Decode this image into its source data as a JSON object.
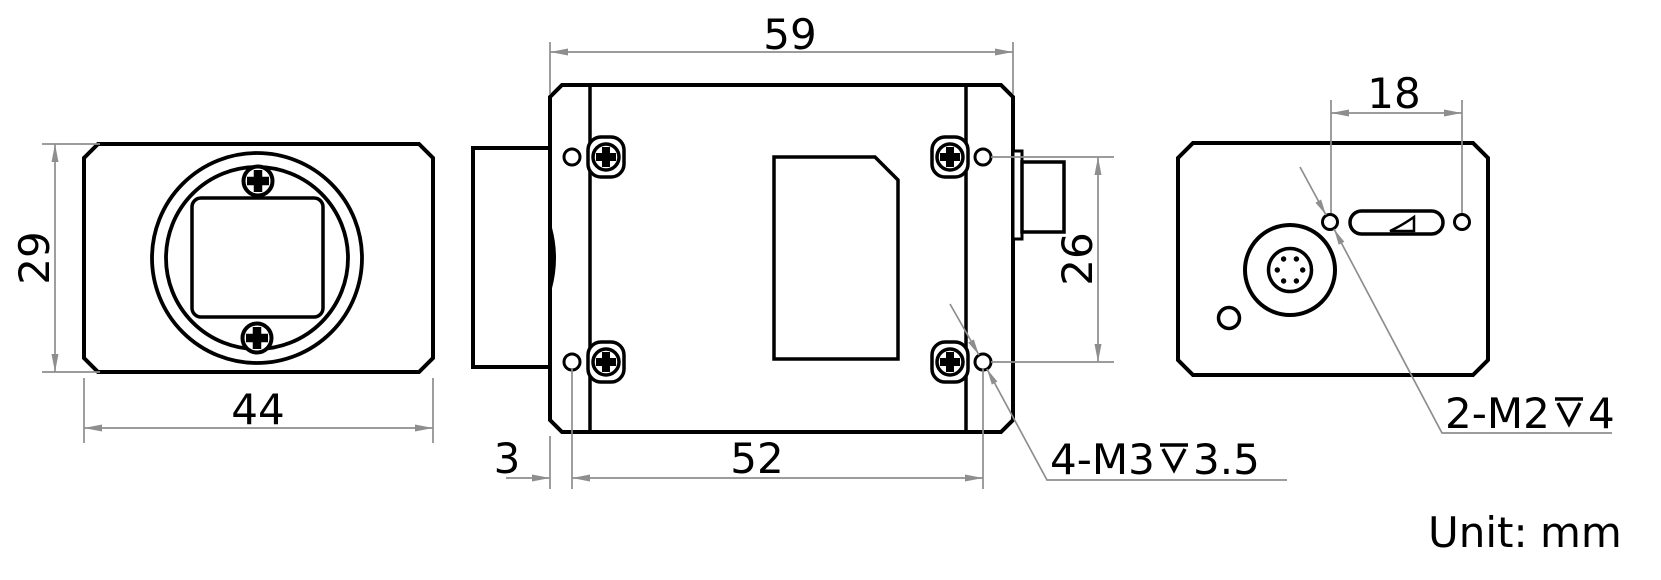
{
  "drawing": {
    "unit_label": "Unit:",
    "unit_value": "mm",
    "object_line_color": "#000000",
    "dimension_line_color": "#8e8e8e",
    "depth_symbol_icon": "⊽"
  },
  "front_view": {
    "dim_width": "44",
    "dim_height": "29"
  },
  "side_view": {
    "dim_length": "59",
    "dim_front_offset": "3",
    "dim_hole_spacing": "52",
    "dim_hole_vertical": "26",
    "thread_note_prefix": "4-M3",
    "thread_note_depth": "3.5"
  },
  "back_view": {
    "dim_hole_spacing": "18",
    "thread_note_prefix": "2-M2",
    "thread_note_depth": "4"
  }
}
